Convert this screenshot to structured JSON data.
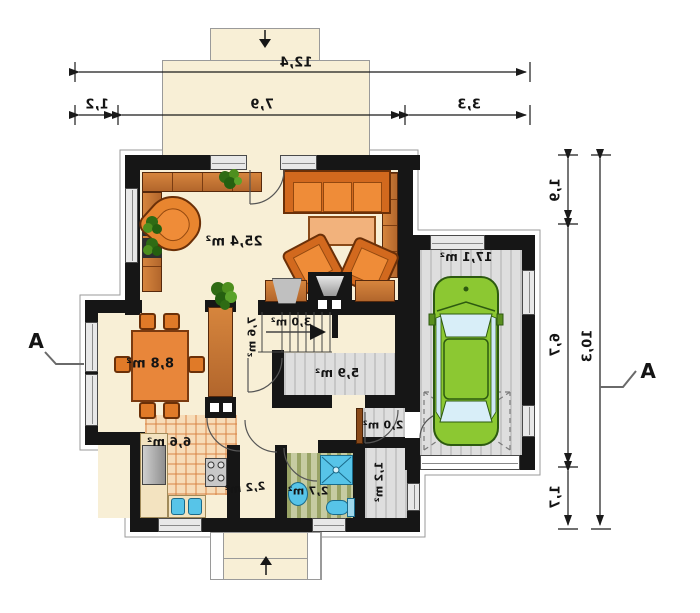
{
  "plan": {
    "rooms": {
      "living": {
        "label": "25,4 m²"
      },
      "garage": {
        "label": "17,1 m²"
      },
      "dining": {
        "label": "8,8 m²"
      },
      "kitchen": {
        "label": "6,6 m²"
      },
      "corridor": {
        "label": "7,6 m²"
      },
      "stairs": {
        "label": "3,0 m²"
      },
      "hall": {
        "label": "5,9 m²"
      },
      "bathroom": {
        "label": "2,7 m²"
      },
      "passage": {
        "label": "2,2 m²"
      },
      "storage": {
        "label": "1,2 m²"
      },
      "vestibule": {
        "label": "2,0 m²"
      }
    },
    "dimensions": {
      "top": {
        "total": "12,4",
        "seg_left": "1,2",
        "seg_mid": "7,9",
        "seg_right": "3,3"
      },
      "right": {
        "total": "10,3",
        "seg_top": "1,9",
        "seg_mid": "6,7",
        "seg_bottom": "1,7"
      }
    },
    "sections": {
      "left": "A",
      "right": "A"
    },
    "colors": {
      "wall": "#161616",
      "floor_cream": "#f8efd6",
      "wood": "#c8722f",
      "upholstery": "#e8852f",
      "fixture_blue": "#57c4e8",
      "car_green": "#8bc832",
      "floor_gray": "#d9d9d9",
      "bath_green": "#b3ba8a"
    }
  }
}
